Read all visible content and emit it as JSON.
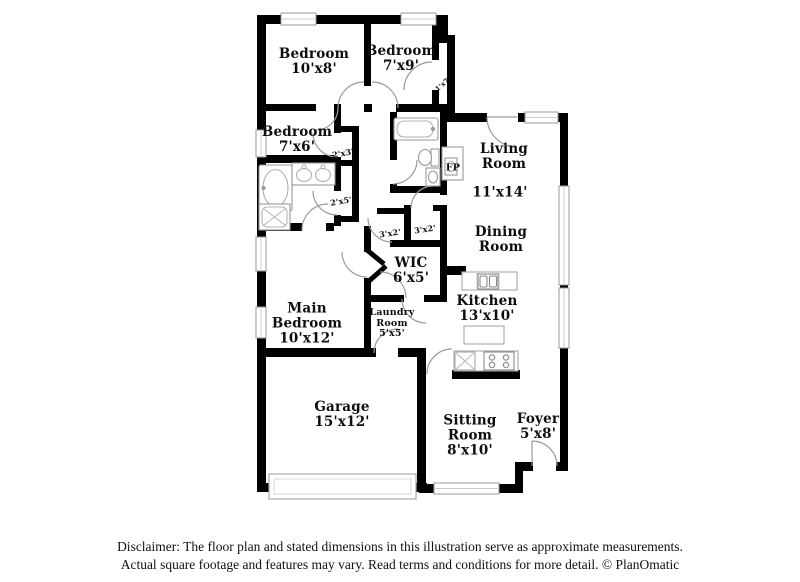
{
  "floorplan": {
    "rooms": {
      "bedroom_top_left": {
        "name": "Bedroom",
        "dims": "10'x8'"
      },
      "bedroom_top_right": {
        "name": "Bedroom",
        "dims": "7'x9'"
      },
      "bedroom_left": {
        "name": "Bedroom",
        "dims": "7'x6'"
      },
      "living_room": {
        "name": "Living Room",
        "dims": "11'x14'"
      },
      "dining_room": {
        "name": "Dining Room",
        "dims": ""
      },
      "main_bedroom": {
        "name": "Main Bedroom",
        "dims": "10'x12'"
      },
      "wic": {
        "name": "WIC",
        "dims": "6'x5'"
      },
      "kitchen": {
        "name": "Kitchen",
        "dims": "13'x10'"
      },
      "laundry_room": {
        "name": "Laundry Room",
        "dims": "5'x5'"
      },
      "garage": {
        "name": "Garage",
        "dims": "15'x12'"
      },
      "sitting_room": {
        "name": "Sitting Room",
        "dims": "8'x10'"
      },
      "foyer": {
        "name": "Foyer",
        "dims": "5'x8'"
      }
    },
    "closets": {
      "closet_1x7": "1'x7'",
      "closet_2x3": "2'x3'",
      "closet_2x5": "2'x5'",
      "closet_3x2_left": "3'x2'",
      "closet_3x2_right": "3'x2'"
    },
    "fireplace_label": "FP",
    "colors": {
      "wall": "#000000",
      "fixture_outline": "#999999",
      "window_fill": "#ffffff"
    }
  },
  "footer": {
    "line1": "Disclaimer: The floor plan and stated dimensions in this illustration serve as approximate measurements.",
    "line2": "Actual square footage and features may vary. Read terms and conditions for more detail. © PlanOmatic"
  }
}
